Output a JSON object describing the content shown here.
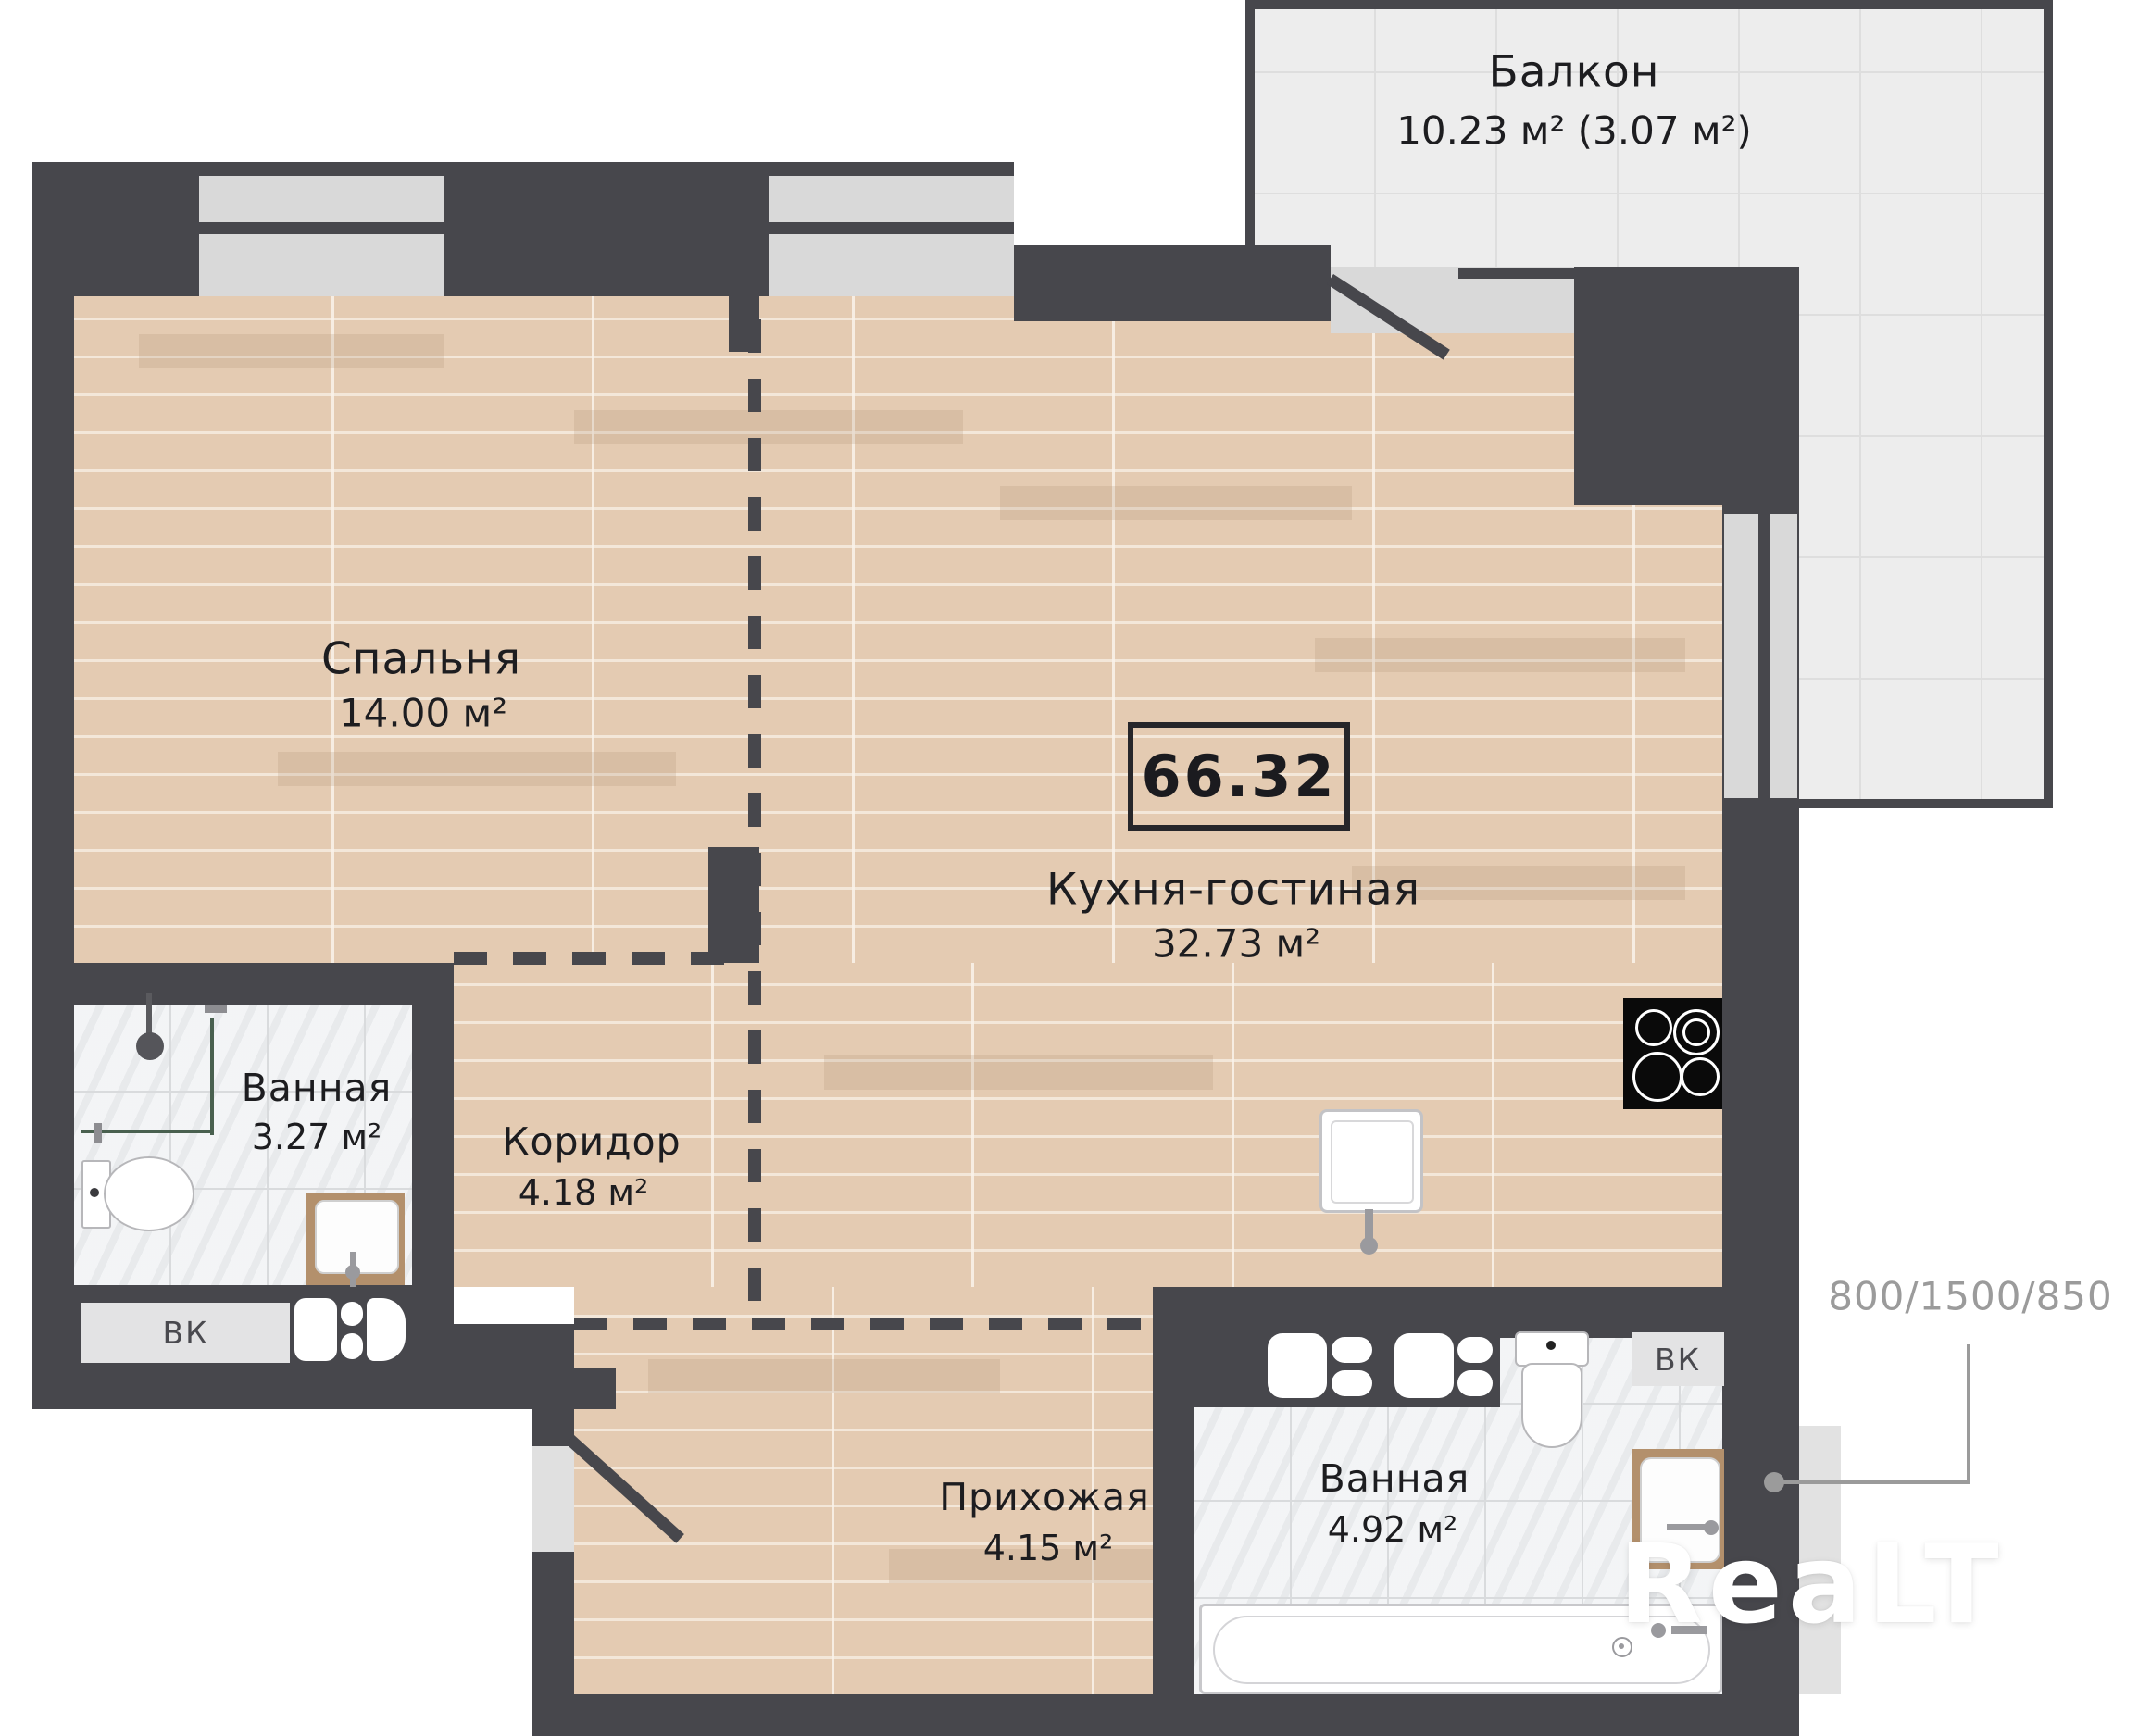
{
  "floorplan": {
    "watermark": "ReaLT",
    "total_area": {
      "value": "66.32"
    },
    "dimension_note": "800/1500/850",
    "rooms": [
      {
        "id": "balcony",
        "name": "Балкон",
        "area": "10.23 м² (3.07 м²)"
      },
      {
        "id": "bedroom",
        "name": "Спальня",
        "area": "14.00 м²"
      },
      {
        "id": "kitchen_living",
        "name": "Кухня-гостиная",
        "area": "32.73 м²"
      },
      {
        "id": "bathroom_small",
        "name": "Ванная",
        "area": "3.27 м²"
      },
      {
        "id": "corridor",
        "name": "Коридор",
        "area": "4.18 м²"
      },
      {
        "id": "hallway",
        "name": "Прихожая",
        "area": "4.15 м²"
      },
      {
        "id": "bathroom_big",
        "name": "Ванная",
        "area": "4.92 м²"
      }
    ],
    "labels": {
      "vent_left": "ВК",
      "vent_right": "ВК"
    },
    "colors": {
      "wall": "#47474c",
      "wood_floor": "#e4cbb2",
      "bath_tile": "#edeff1",
      "balcony_tile": "#ededed",
      "window": "#d9d9d9",
      "label_text": "#1d1d20",
      "dim_text": "#9b9b9b",
      "vanity_wood": "#b3906c",
      "stove": "#0a0a0a"
    },
    "icons": {
      "stove-icon": "black square with 4 white burner rings",
      "shower-head-icon": "dark gray circle with stem",
      "toilet-icon": "white tank + oval bowl",
      "sink-icon": "white basin square with faucet",
      "bathtub-icon": "white rounded tub with drain",
      "washing-machine-icon": "white rounded square with pill vents",
      "door-swing-icon": "diagonal dark leaf line",
      "vent-shaft-icon": "gray box labeled ВК"
    }
  }
}
